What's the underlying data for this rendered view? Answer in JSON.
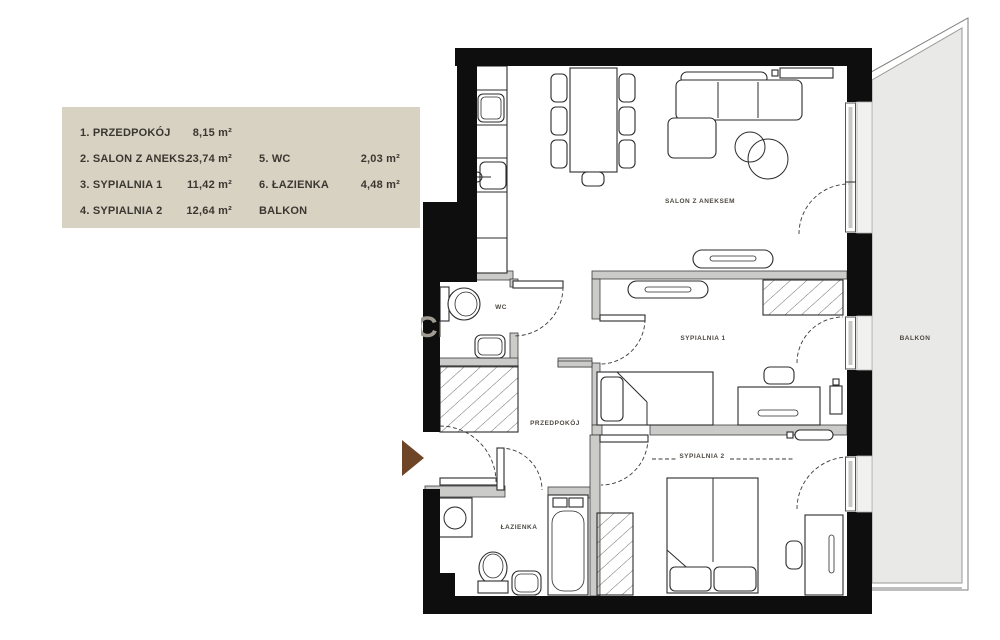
{
  "colors": {
    "legend_bg": "#d8d2c2",
    "legend_text": "#3a3731",
    "wall_black": "#0e0e0e",
    "balcony_gray": "#e9e9e7",
    "accent_brown": "#6f4527"
  },
  "legend": {
    "items": [
      {
        "name": "1. PRZEDPOKÓJ",
        "area": "8,15 m²"
      },
      {
        "name": "2. SALON Z ANEKS.",
        "area": "23,74 m²"
      },
      {
        "name": "3. SYPIALNIA 1",
        "area": "11,42 m²"
      },
      {
        "name": "4. SYPIALNIA 2",
        "area": "12,64 m²"
      },
      {
        "name": "5. WC",
        "area": "2,03 m²"
      },
      {
        "name": "6. ŁAZIENKA",
        "area": "4,48 m²"
      },
      {
        "name": "BALKON",
        "area": ""
      }
    ]
  },
  "plan": {
    "rooms": {
      "salon": "SALON Z ANEKSEM",
      "sypialnia1": "SYPIALNIA 1",
      "sypialnia2": "SYPIALNIA 2",
      "przedpokoj": "PRZEDPOKÓJ",
      "wc": "WC",
      "lazienka": "ŁAZIENKA",
      "balkon": "BALKON"
    },
    "watermark": "Cr"
  }
}
